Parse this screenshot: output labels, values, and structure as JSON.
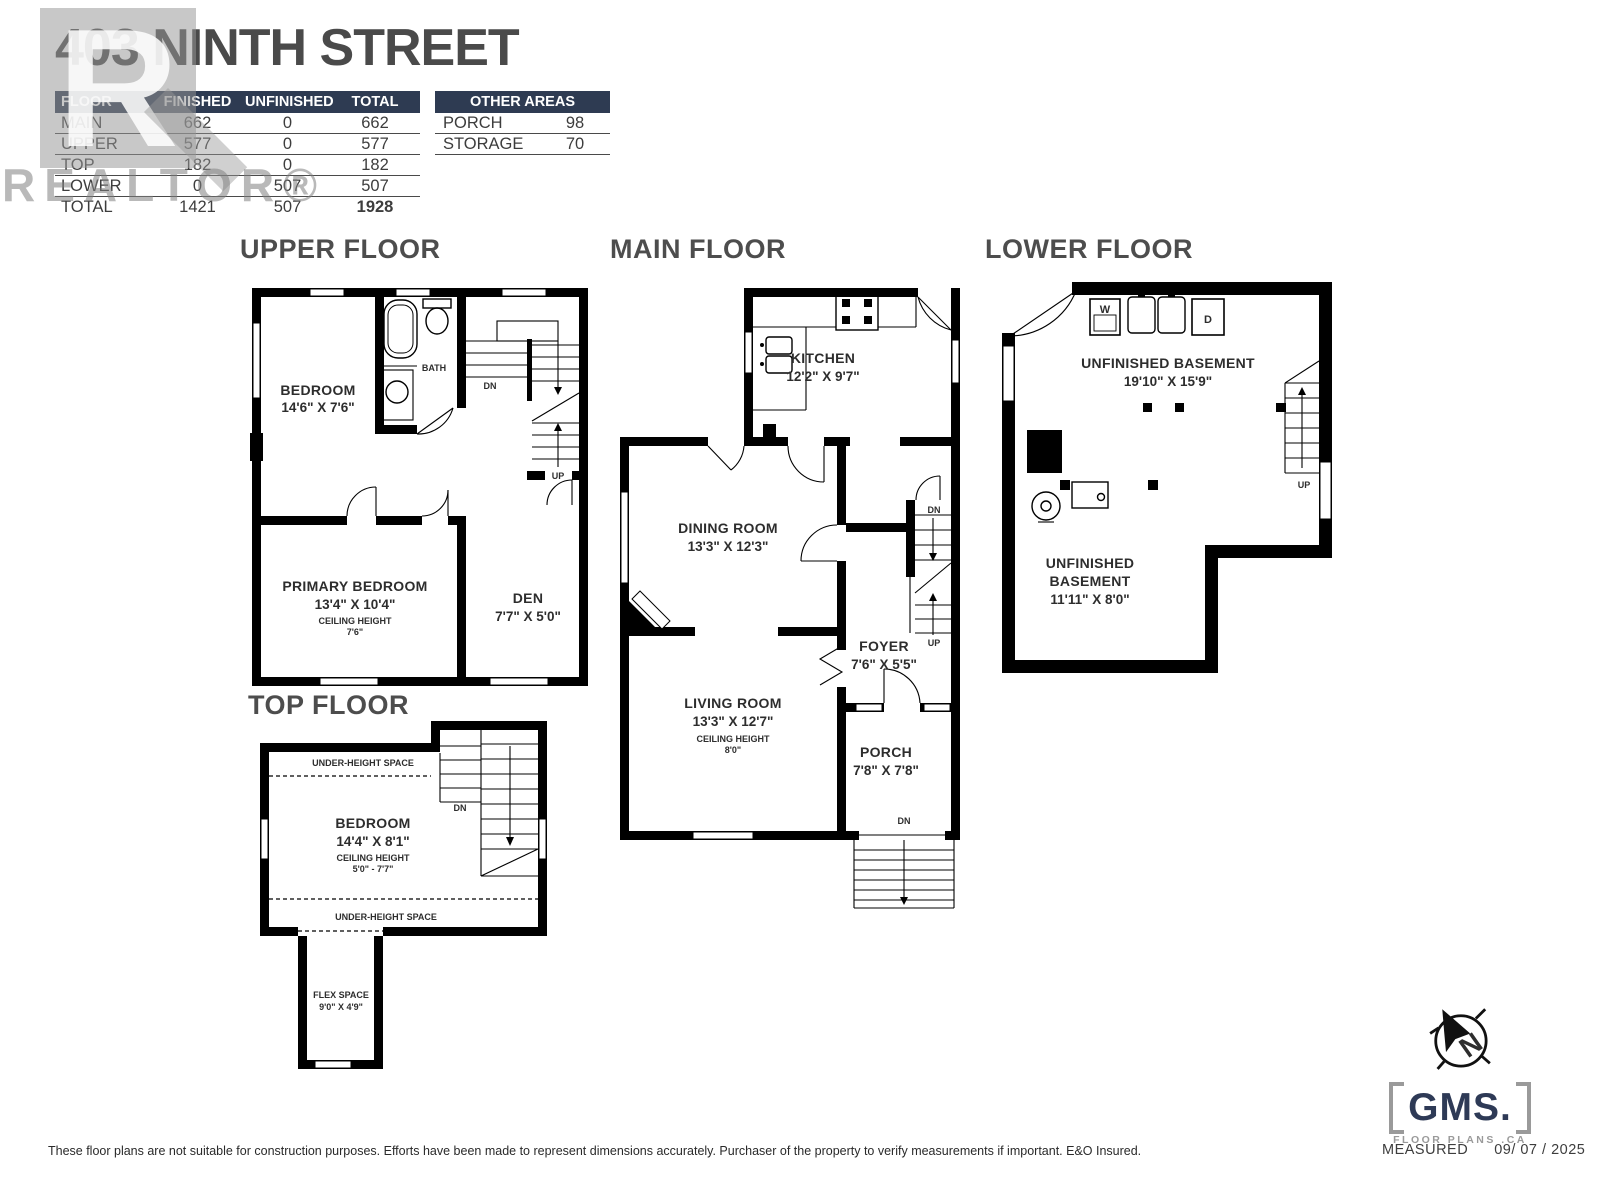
{
  "header": {
    "title": "403 NINTH STREET",
    "floor_table": {
      "headers": [
        "FLOOR",
        "FINISHED",
        "UNFINISHED",
        "TOTAL"
      ],
      "rows": [
        {
          "floor": "MAIN",
          "finished": "662",
          "unfinished": "0",
          "total": "662"
        },
        {
          "floor": "UPPER",
          "finished": "577",
          "unfinished": "0",
          "total": "577"
        },
        {
          "floor": "TOP",
          "finished": "182",
          "unfinished": "0",
          "total": "182"
        },
        {
          "floor": "LOWER",
          "finished": "0",
          "unfinished": "507",
          "total": "507"
        }
      ],
      "total_row": {
        "floor": "TOTAL",
        "finished": "1421",
        "unfinished": "507",
        "total": "1928"
      }
    },
    "other_areas": {
      "title": "OTHER AREAS",
      "rows": [
        {
          "name": "PORCH",
          "value": "98"
        },
        {
          "name": "STORAGE",
          "value": "70"
        }
      ]
    }
  },
  "watermark": {
    "letter": "R",
    "text": "REALTOR®"
  },
  "upper_floor": {
    "title": "UPPER FLOOR",
    "bedroom_name": "BEDROOM",
    "bedroom_dims": "14'6\" X 7'6\"",
    "bath": "BATH",
    "dn": "DN",
    "up": "UP",
    "primary_name": "PRIMARY BEDROOM",
    "primary_dims": "13'4\" X 10'4\"",
    "primary_ceiling_label": "CEILING HEIGHT",
    "primary_ceiling": "7'6\"",
    "den_name": "DEN",
    "den_dims": "7'7\" X 5'0\""
  },
  "main_floor": {
    "title": "MAIN FLOOR",
    "kitchen_name": "KITCHEN",
    "kitchen_dims": "12'2\" X 9'7\"",
    "dining_name": "DINING ROOM",
    "dining_dims": "13'3\" X 12'3\"",
    "living_name": "LIVING ROOM",
    "living_dims": "13'3\" X 12'7\"",
    "living_ceiling_label": "CEILING HEIGHT",
    "living_ceiling": "8'0\"",
    "foyer_name": "FOYER",
    "foyer_dims": "7'6\" X 5'5\"",
    "porch_name": "PORCH",
    "porch_dims": "7'8\" X 7'8\"",
    "dn": "DN",
    "up": "UP",
    "porch_dn": "DN"
  },
  "lower_floor": {
    "title": "LOWER FLOOR",
    "basement_name": "UNFINISHED BASEMENT",
    "basement_dims": "19'10\" X 15'9\"",
    "basement2_line1": "UNFINISHED",
    "basement2_line2": "BASEMENT",
    "basement2_dims": "11'11\" X 8'0\"",
    "up": "UP",
    "washer": "W",
    "dryer": "D"
  },
  "top_floor": {
    "title": "TOP FLOOR",
    "under_height_top": "UNDER-HEIGHT SPACE",
    "under_height_bottom": "UNDER-HEIGHT SPACE",
    "bedroom_name": "BEDROOM",
    "bedroom_dims": "14'4\" X 8'1\"",
    "ceiling_label": "CEILING HEIGHT",
    "ceiling_value": "5'0\" - 7'7\"",
    "flex_name": "FLEX SPACE",
    "flex_dims": "9'0\" X 4'9\"",
    "dn": "DN"
  },
  "branding": {
    "compass_letter": "N",
    "logo_text": "GMS.",
    "logo_subtext": "FLOOR PLANS .CA",
    "measured_label": "MEASURED",
    "measured_date": "09/ 07 / 2025"
  },
  "footer": {
    "disclaimer": "These floor plans are not suitable for construction purposes. Efforts have been made to represent dimensions accurately.  Purchaser of the property to verify measurements if important.  E&O Insured."
  },
  "colors": {
    "navy": "#2e3b52",
    "label_gray": "#4d4d4d",
    "wall_black": "#000000"
  }
}
